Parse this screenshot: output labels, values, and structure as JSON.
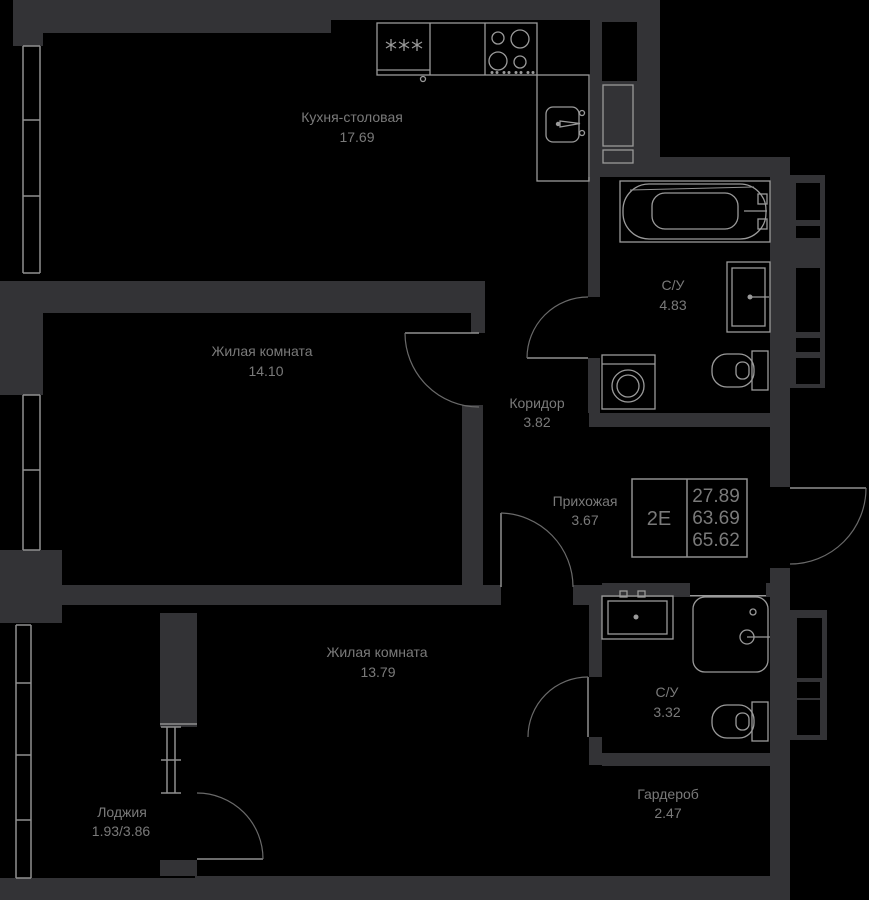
{
  "colors": {
    "background": "#000000",
    "wall": "#333336",
    "line": "#8f8f8f",
    "fixture": "#9a9a9a",
    "arc": "#6a6a6a",
    "text": "#7a7a7a"
  },
  "plan": {
    "unit_label": "2Е",
    "values": [
      "27.89",
      "63.69",
      "65.62"
    ]
  },
  "rooms": [
    {
      "name": "Кухня-столовая",
      "area": "17.69"
    },
    {
      "name": "Жилая комната",
      "area": "14.10"
    },
    {
      "name": "Коридор",
      "area": "3.82"
    },
    {
      "name": "С/У",
      "area": "4.83"
    },
    {
      "name": "Прихожая",
      "area": "3.67"
    },
    {
      "name": "Жилая комната",
      "area": "13.79"
    },
    {
      "name": "С/У",
      "area": "3.32"
    },
    {
      "name": "Гардероб",
      "area": "2.47"
    },
    {
      "name": "Лоджия",
      "area": "1.93/3.86"
    }
  ]
}
